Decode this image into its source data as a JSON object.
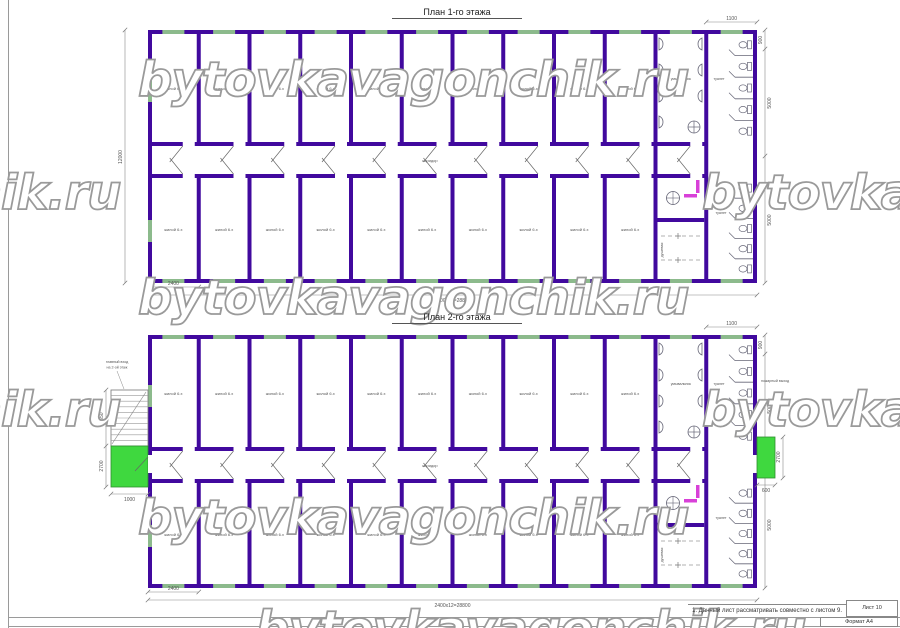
{
  "watermark": {
    "text": "bytovkavagonchik.ru"
  },
  "plans": [
    {
      "title": "План 1-го этажа"
    },
    {
      "title": "План 2-го этажа"
    }
  ],
  "labels": {
    "room": "жилой 6.х",
    "corridor": "коридор",
    "washroom": "умывальник",
    "toilet": "туалет",
    "shower": "душевая",
    "entrance_line1": "главный вход",
    "entrance_line2": "на 2-ой этаж",
    "fire_exit": "пожарный выход"
  },
  "dimensions": {
    "bay": "2400",
    "bay_total": "2400х12=28800",
    "height_total": "12000",
    "toilet_width": "1100",
    "stall_depth": "900",
    "half_depth": "5000",
    "stair_length": "2650",
    "landing_length": "2700",
    "landing_width": "1000",
    "exit_width": "600",
    "exit_length": "2700"
  },
  "note": {
    "text": "1. Данный лист рассматривать совместно с листом 9."
  },
  "titleblock": {
    "sheet": "Лист 10",
    "format": "Формат А4"
  },
  "colors": {
    "wall": "#41099E",
    "window": "#8CBA8C",
    "landing": "#3FD83F",
    "door_accent": "#D840D8"
  }
}
